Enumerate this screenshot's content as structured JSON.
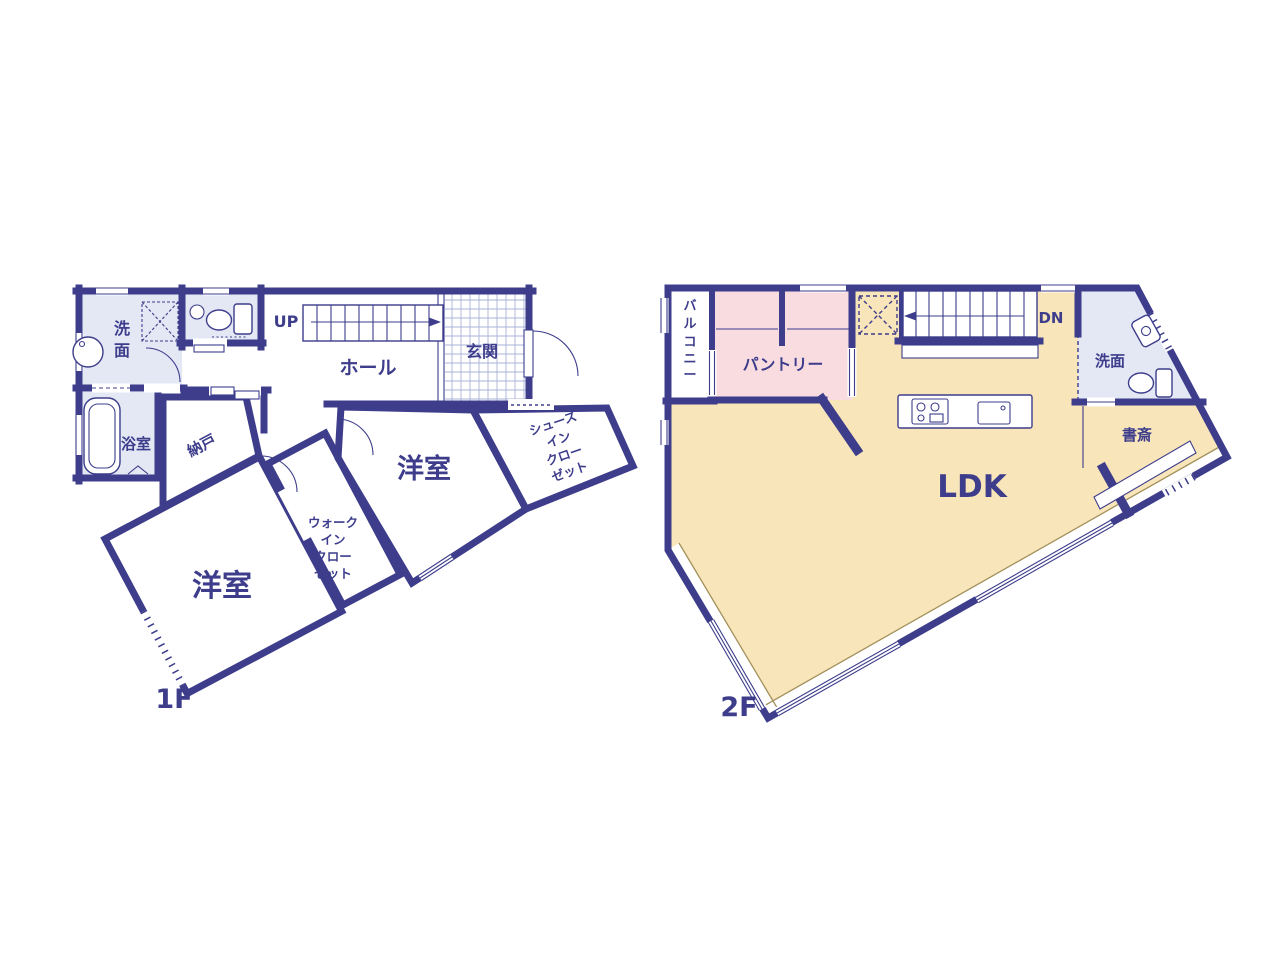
{
  "colors": {
    "wall_navy": "#3d3d8c",
    "room_cream": "#f8e5ba",
    "closet_pink": "#f9dce0",
    "wet_area_blue": "#e3e8f4",
    "tile_line": "#aab1d8",
    "floor_edge_line": "#a3915c"
  },
  "floor1": {
    "floor_label": "1F",
    "washroom_chars": [
      "洗",
      "面"
    ],
    "bathroom": "浴室",
    "hall": "ホール",
    "entrance": "玄関",
    "stairs_up": "UP",
    "storage": "納戸",
    "bedroom_a": "洋室",
    "bedroom_b": "洋室",
    "wic_lines": [
      "ウォーク",
      "イン",
      "クロー",
      "ゼット"
    ],
    "sic_lines": [
      "シューズ",
      "イン",
      "クロー",
      "ゼット"
    ]
  },
  "floor2": {
    "floor_label": "2F",
    "balcony_chars": [
      "バ",
      "ル",
      "コ",
      "ニ",
      "ー"
    ],
    "pantry": "パントリー",
    "stairs_down": "DN",
    "washroom": "洗面",
    "study": "書斎",
    "ldk": "LDK"
  }
}
